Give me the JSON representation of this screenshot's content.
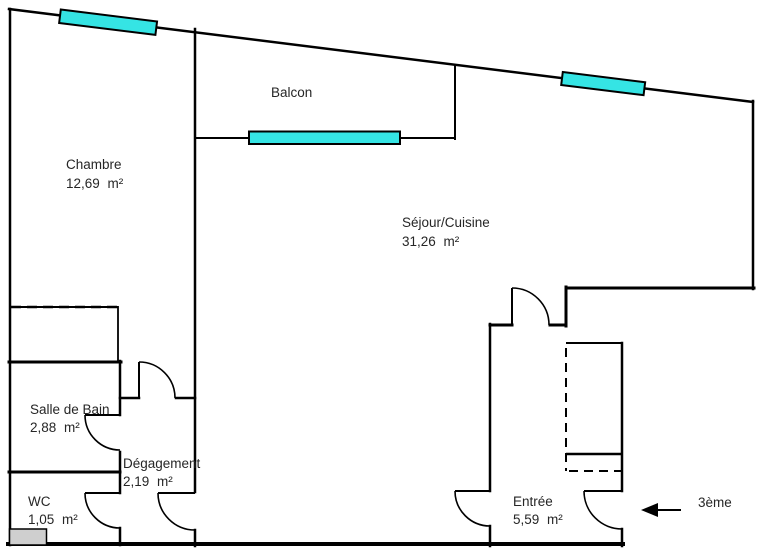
{
  "plan": {
    "type": "apartment-floor-plan",
    "rooms": {
      "balcon": {
        "label": "Balcon",
        "area": ""
      },
      "chambre": {
        "label": "Chambre",
        "area": "12,69 m²"
      },
      "sejour": {
        "label": "Séjour/Cuisine",
        "area": "31,26 m²"
      },
      "sdb": {
        "label": "Salle de Bain",
        "area": "2,88 m²"
      },
      "degagement": {
        "label": "Dégagement",
        "area": "2,19 m²"
      },
      "wc": {
        "label": "WC",
        "area": "1,05 m²"
      },
      "entree": {
        "label": "Entrée",
        "area": "5,59 m²"
      }
    },
    "annotations": {
      "floor": "3ème"
    },
    "features": {
      "windows": [
        "chambre-window",
        "balcon-window",
        "sejour-window"
      ],
      "closets": [
        "chambre-closet",
        "entree-closet"
      ],
      "entrance_arrow": "points-left-to-entrance-door"
    },
    "colors": {
      "wall": "#000000",
      "window_fill": "#35e4e4",
      "cabinet_fill": "#cfcfcf",
      "text": "#262626"
    }
  }
}
